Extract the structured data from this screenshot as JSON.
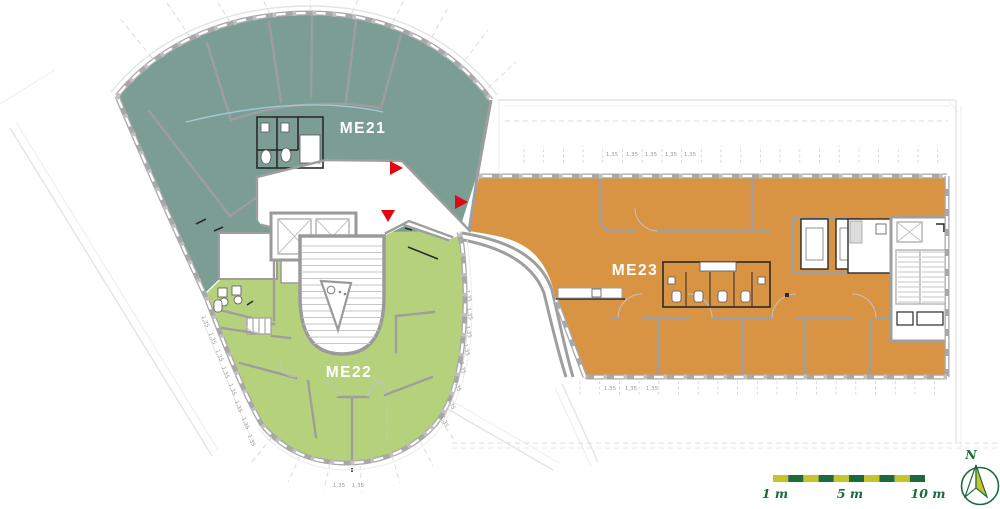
{
  "units": {
    "me21": {
      "label": "ME21",
      "color": "#7C9D94"
    },
    "me22": {
      "label": "ME22",
      "color": "#B6D17C"
    },
    "me23": {
      "label": "ME23",
      "color": "#D99443"
    }
  },
  "dimensions": {
    "label": "1,35"
  },
  "entrance_markers": {
    "color": "#E30613",
    "count": 3
  },
  "scale_bar": {
    "labels": [
      "1 m",
      "5 m",
      "10 m"
    ],
    "segment_count": 10,
    "colors": [
      "#C9C32B",
      "#1B6B3C"
    ],
    "text_color": "#1B6B3C"
  },
  "compass": {
    "label": "N",
    "ring_color": "#1B6B3C",
    "needle_fill": "#C9C32B"
  },
  "palette": {
    "wall": "#A8A8A8",
    "wall_interior": "#9E9E9E",
    "wall_dark": "#2A2A2A",
    "mullion": "#C0C0C0",
    "glazing": "#9FC9D2",
    "faint": "#E4E4E4",
    "dim_text": "#9A9A9A",
    "unit_label_text": "#FFFFFF"
  }
}
